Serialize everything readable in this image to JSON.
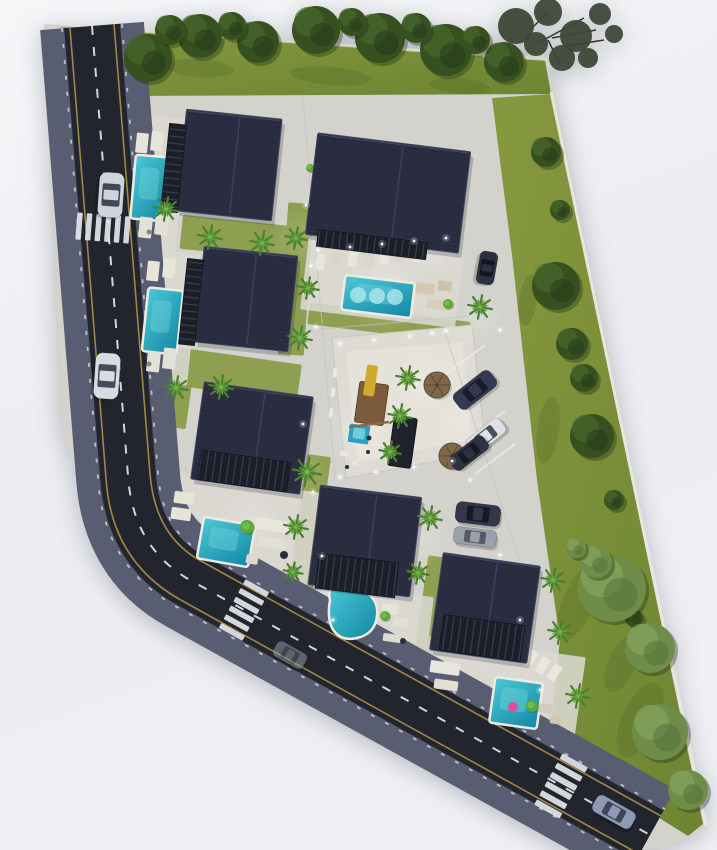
{
  "meta": {
    "label": "villa-resort-site-plan-rendering",
    "width": 717,
    "height": 850
  },
  "palette": {
    "background_top": "#f5f6f8",
    "background_bottom": "#f0f1f4",
    "ground": "#d3d2cc",
    "plaza": "#dedbd4",
    "lawn_light": "#87993f",
    "lawn_dark": "#6d8431",
    "grass_patch": "#8b9c4a",
    "asphalt": "#23252e",
    "curb": "#585d72",
    "road_yellow_line": "#b5974a",
    "road_white": "#e6e8ea",
    "roof_dark": "#2b2e41",
    "slat_dark": "#1c1e28",
    "pool_light": "#47c4d4",
    "pool_dark": "#1287a3",
    "pool_deck": "#eeece2",
    "palm_green": "#4c8030",
    "tree_green": "#36511f",
    "lush_tree_green": "#6f8d49",
    "umbrella_straw": "#7e6848",
    "car_silver": "#d4d7de",
    "car_dark": "#32364a",
    "float_pink": "#d94fa0",
    "playground_wood": "#7b5b39",
    "slide_yellow": "#d2a92f",
    "light_glow": "#ffffff"
  },
  "site": {
    "points": "44,24 548,57 706,828 664,849 614,850 92,520 60,424"
  },
  "lawns": [
    {
      "id": "lawn-top",
      "points": "60,26 545,60 551,94 118,96"
    },
    {
      "id": "lawn-right",
      "points": "492,98 551,94 703,824 688,836 548,748 560,640 537,480 512,255"
    }
  ],
  "lawn_blotches": [
    [
      200,
      68,
      34,
      9,
      4
    ],
    [
      330,
      76,
      40,
      9,
      5
    ],
    [
      460,
      86,
      30,
      8,
      5
    ],
    [
      528,
      300,
      9,
      26,
      8
    ],
    [
      548,
      430,
      11,
      34,
      8
    ],
    [
      580,
      600,
      16,
      44,
      25
    ],
    [
      640,
      720,
      18,
      40,
      25
    ],
    [
      622,
      664,
      14,
      30,
      25
    ]
  ],
  "curb_lines": [
    {
      "d": "M551,92 L706,826",
      "w": 3,
      "c": "#edeae2",
      "o": 0.85
    },
    {
      "d": "M60,26 L546,60",
      "w": 2,
      "c": "#e8e6de",
      "o": 0.6
    }
  ],
  "green_patches": [
    [
      181,
      221,
      120,
      34,
      6
    ],
    [
      148,
      354,
      152,
      38,
      8
    ],
    [
      283,
      203,
      26,
      152,
      4
    ],
    [
      308,
      312,
      162,
      22,
      7
    ],
    [
      298,
      455,
      24,
      132,
      8
    ],
    [
      421,
      556,
      18,
      104,
      8
    ],
    [
      167,
      380,
      22,
      48,
      8
    ]
  ],
  "plaza": {
    "outer": "332,338 472,325 486,452 346,478",
    "inner": "346,352 462,342 472,440 357,462"
  },
  "pads": [
    [
      126,
      116,
      56,
      134,
      6
    ],
    [
      136,
      251,
      58,
      132,
      6
    ],
    [
      304,
      245,
      156,
      74,
      7
    ],
    [
      166,
      482,
      148,
      94,
      8
    ],
    [
      316,
      590,
      114,
      70,
      7
    ],
    [
      422,
      646,
      158,
      94,
      8
    ]
  ],
  "glows": [
    [
      385,
      290,
      42,
      0.3
    ],
    [
      300,
      240,
      30,
      0.2
    ],
    [
      255,
      330,
      30,
      0.2
    ],
    [
      230,
      190,
      28,
      0.18
    ],
    [
      355,
      432,
      38,
      0.26
    ],
    [
      300,
      470,
      28,
      0.2
    ],
    [
      424,
      382,
      30,
      0.24
    ],
    [
      462,
      422,
      26,
      0.2
    ],
    [
      250,
      522,
      30,
      0.2
    ],
    [
      422,
      540,
      28,
      0.2
    ],
    [
      352,
      612,
      28,
      0.2
    ],
    [
      482,
      642,
      30,
      0.22
    ],
    [
      520,
      720,
      26,
      0.2
    ],
    [
      160,
      180,
      24,
      0.15
    ],
    [
      432,
      252,
      26,
      0.18
    ],
    [
      480,
      320,
      24,
      0.2
    ]
  ],
  "road": {
    "center": "M92,26 L128,476 Q133,548 190,580 L650,835",
    "curb_w": 104,
    "asphalt_w": 56,
    "yellow": [
      "M114,24 L150,474 Q155,536 201,561 L661,816",
      "M70,28 L106,478 Q111,560 179,599 L639,854"
    ],
    "ticks": [
      "M122,24 L158,474 Q163,533 205,554 L665,809",
      "M62,28 L98,478 Q103,565 175,606 L635,861"
    ],
    "dash_pattern": "9 12"
  },
  "crosswalks": [
    {
      "id": "crosswalk-north",
      "cx": 103,
      "cy": 228,
      "rot": 4.5,
      "dir": "v",
      "n": 6,
      "step": 9.6,
      "bw": 5.5,
      "bl": 27
    },
    {
      "id": "crosswalk-southwest",
      "cx": 244,
      "cy": 610,
      "rot": 29,
      "dir": "h",
      "n": 6,
      "step": 10,
      "bw": 5.5,
      "bl": 27
    },
    {
      "id": "crosswalk-southeast",
      "cx": 561,
      "cy": 786,
      "rot": 29,
      "dir": "h",
      "n": 6,
      "step": 10.5,
      "bw": 6,
      "bl": 29
    }
  ],
  "parking_lines": [
    [
      445,
      375,
      485,
      345
    ],
    [
      455,
      408,
      495,
      378
    ],
    [
      465,
      441,
      505,
      411
    ],
    [
      475,
      474,
      515,
      444
    ]
  ],
  "drive_lines": [
    [
      303,
      98,
      335,
      478
    ],
    [
      445,
      332,
      520,
      562
    ],
    [
      310,
      330,
      470,
      316
    ]
  ],
  "villas": [
    {
      "id": "villa-1",
      "roof": [
        181,
        114,
        96,
        102,
        6
      ],
      "slats": [
        165,
        124,
        17,
        88,
        6
      ],
      "slatDir": "h"
    },
    {
      "id": "villa-2",
      "roof": [
        199,
        251,
        94,
        96,
        6
      ],
      "slats": [
        183,
        259,
        16,
        86,
        6
      ],
      "slatDir": "h"
    },
    {
      "id": "villa-3",
      "roof": [
        311,
        142,
        154,
        102,
        7
      ],
      "slats": [
        317,
        236,
        110,
        17,
        7
      ],
      "slatDir": "v"
    },
    {
      "id": "villa-4",
      "roof": [
        197,
        389,
        110,
        98,
        8
      ],
      "slats": [
        199,
        456,
        90,
        30,
        8
      ],
      "slatDir": "v"
    },
    {
      "id": "villa-5",
      "roof": [
        314,
        491,
        102,
        100,
        7
      ],
      "slats": [
        317,
        558,
        80,
        35,
        7
      ],
      "slatDir": "v"
    },
    {
      "id": "villa-6",
      "roof": [
        436,
        559,
        98,
        98,
        8
      ],
      "slats": [
        441,
        620,
        82,
        36,
        8
      ],
      "slatDir": "v"
    }
  ],
  "pools": [
    [
      133,
      156,
      35,
      64,
      5
    ],
    [
      145,
      289,
      35,
      64,
      6
    ],
    [
      343,
      279,
      70,
      35,
      7
    ],
    [
      200,
      521,
      52,
      42,
      10
    ],
    [
      492,
      680,
      48,
      46,
      8
    ]
  ],
  "pool_kidney": "M330,600 Q326,586 341,584 Q357,582 366,592 Q379,601 377,616 Q375,634 357,638 Q340,642 332,628 Q327,617 330,600 Z",
  "pool_circles": [
    [
      358,
      295,
      8
    ],
    [
      377,
      296,
      8
    ],
    [
      395,
      297,
      8
    ]
  ],
  "pool_float": [
    513,
    707,
    5
  ],
  "kids_pool": {
    "rect": [
      348,
      424,
      22,
      20,
      8
    ],
    "inner": [
      353,
      428,
      12,
      11,
      8
    ]
  },
  "playground": {
    "platform": [
      357,
      383,
      29,
      41,
      8
    ],
    "slide": [
      365,
      365,
      11,
      31,
      8
    ],
    "beam": [
      349,
      427,
      389,
      422
    ],
    "dots": [
      [
        369,
        438,
        2.5
      ],
      [
        368,
        452,
        2
      ],
      [
        347,
        467,
        2
      ]
    ],
    "bits": [
      [
        340,
        451,
        8,
        5,
        8
      ],
      [
        352,
        461,
        6,
        4,
        8
      ]
    ]
  },
  "pavilion": [
    391,
    417,
    23,
    50,
    8
  ],
  "furniture": [
    [
      136,
      133,
      12,
      20,
      6,
      "#e7e4da"
    ],
    [
      151,
      131,
      12,
      20,
      6,
      "#e7e4da"
    ],
    [
      139,
      217,
      13,
      21,
      6,
      "#e3e0d6"
    ],
    [
      155,
      214,
      13,
      21,
      6,
      "#e3e0d6"
    ],
    [
      147,
      261,
      12,
      20,
      6,
      "#e7e4da"
    ],
    [
      163,
      258,
      12,
      20,
      6,
      "#e7e4da"
    ],
    [
      147,
      351,
      13,
      21,
      6,
      "#e3e0d6"
    ],
    [
      163,
      348,
      13,
      21,
      6,
      "#e3e0d6"
    ],
    [
      316,
      254,
      9,
      16,
      7,
      "#e8e5db"
    ],
    [
      332,
      252,
      9,
      16,
      7,
      "#d9d5c9"
    ],
    [
      348,
      251,
      9,
      16,
      7,
      "#e8e5db"
    ],
    [
      364,
      250,
      9,
      16,
      7,
      "#d9d5c9"
    ],
    [
      380,
      248,
      9,
      16,
      7,
      "#e8e5db"
    ],
    [
      396,
      247,
      9,
      16,
      7,
      "#d9d5c9"
    ],
    [
      412,
      246,
      9,
      16,
      7,
      "#e8e5db"
    ],
    [
      416,
      283,
      18,
      11,
      7,
      "#d4c8b2"
    ],
    [
      438,
      281,
      14,
      10,
      7,
      "#cfc2aa"
    ],
    [
      427,
      300,
      22,
      9,
      7,
      "#d8cdb8"
    ],
    [
      174,
      492,
      20,
      12,
      8,
      "#e6e3d9"
    ],
    [
      171,
      508,
      20,
      12,
      8,
      "#e6e3d9"
    ],
    [
      254,
      519,
      34,
      12,
      10,
      "#e8e5dc"
    ],
    [
      258,
      538,
      28,
      10,
      10,
      "#e2dfd5"
    ],
    [
      246,
      555,
      12,
      9,
      10,
      "#dcd8cd"
    ],
    [
      382,
      604,
      16,
      10,
      8,
      "#e6e3d9"
    ],
    [
      394,
      618,
      14,
      9,
      8,
      "#e2dfd5"
    ],
    [
      383,
      634,
      18,
      8,
      8,
      "#dedbd1"
    ],
    [
      430,
      662,
      30,
      12,
      8,
      "#e8e5dc"
    ],
    [
      434,
      680,
      24,
      10,
      8,
      "#e2dfd5"
    ],
    [
      526,
      650,
      9,
      17,
      32,
      "#eae7dd"
    ],
    [
      538,
      657,
      9,
      17,
      32,
      "#eae7dd"
    ],
    [
      550,
      664,
      9,
      17,
      32,
      "#eae7dd"
    ],
    [
      538,
      704,
      14,
      9,
      8,
      "#d6cbbb"
    ],
    [
      550,
      716,
      12,
      8,
      8,
      "#d2c6b5"
    ],
    [
      333,
      368,
      4,
      9,
      8,
      "#eceadf"
    ],
    [
      331,
      388,
      4,
      9,
      8,
      "#eceadf"
    ],
    [
      329,
      408,
      4,
      9,
      8,
      "#eceadf"
    ]
  ],
  "tables": [
    [
      284,
      555,
      4,
      "#2b2e3a"
    ],
    [
      403,
      641,
      3,
      "#2b2e3a"
    ],
    [
      149,
      232,
      2.5,
      "#8a857c"
    ],
    [
      149,
      364,
      2.5,
      "#8a857c"
    ]
  ],
  "bushes": [
    [
      247,
      527,
      7
    ],
    [
      532,
      706,
      6
    ],
    [
      385,
      616,
      5
    ],
    [
      448,
      304,
      5
    ],
    [
      310,
      168,
      4
    ]
  ],
  "umbrellas": [
    [
      437,
      385,
      13
    ],
    [
      452,
      456,
      13
    ]
  ],
  "cars": [
    {
      "id": "car-sedan-north",
      "c": [
        111,
        195
      ],
      "l": 45,
      "w": 25,
      "rot": 94,
      "body": "#cfd3db",
      "glass": "#424759",
      "o": 1
    },
    {
      "id": "car-sedan-west",
      "c": [
        107,
        376
      ],
      "l": 46,
      "w": 25,
      "rot": 94,
      "body": "#d8dbe1",
      "glass": "#454a5c",
      "o": 1
    },
    {
      "id": "car-ghost-south",
      "c": [
        290,
        655
      ],
      "l": 34,
      "w": 17,
      "rot": 29,
      "body": "#9aa0ac",
      "glass": "#5d6270",
      "o": 0.5
    },
    {
      "id": "car-sedan-southeast",
      "c": [
        614,
        812
      ],
      "l": 44,
      "w": 19,
      "rot": 29,
      "body": "#8e99b4",
      "glass": "#3e4559",
      "o": 1
    },
    {
      "id": "car-drive-east",
      "c": [
        487,
        268
      ],
      "l": 33,
      "w": 18,
      "rot": 100,
      "body": "#2c3040",
      "glass": "#14161f",
      "o": 1
    },
    {
      "id": "car-parked-suv",
      "c": [
        475,
        390
      ],
      "l": 46,
      "w": 20,
      "rot": -38,
      "body": "#343850",
      "glass": "#181b28",
      "o": 1
    },
    {
      "id": "car-parked-white",
      "c": [
        486,
        436
      ],
      "l": 42,
      "w": 18,
      "rot": -38,
      "body": "#dfe1e6",
      "glass": "#4a4f60",
      "o": 1
    },
    {
      "id": "car-parked-dark",
      "c": [
        469,
        453
      ],
      "l": 42,
      "w": 17,
      "rot": -38,
      "body": "#2d3142",
      "glass": "#161926",
      "o": 1
    },
    {
      "id": "car-villa6-suv",
      "c": [
        478,
        514
      ],
      "l": 45,
      "w": 21,
      "rot": 7,
      "body": "#333749",
      "glass": "#161923",
      "o": 1
    },
    {
      "id": "car-villa6-gray",
      "c": [
        475,
        537
      ],
      "l": 43,
      "w": 17,
      "rot": 7,
      "body": "#9ba1ab",
      "glass": "#555a68",
      "o": 1
    }
  ],
  "palms": [
    [
      166,
      209,
      1
    ],
    [
      210,
      237,
      1
    ],
    [
      262,
      243,
      1
    ],
    [
      296,
      238,
      0.9
    ],
    [
      176,
      388,
      1
    ],
    [
      221,
      387,
      1
    ],
    [
      300,
      338,
      1
    ],
    [
      308,
      288,
      0.9
    ],
    [
      307,
      472,
      1.2
    ],
    [
      296,
      527,
      1
    ],
    [
      408,
      378,
      1
    ],
    [
      400,
      416,
      1
    ],
    [
      390,
      452,
      0.9
    ],
    [
      480,
      307,
      1
    ],
    [
      430,
      518,
      1
    ],
    [
      418,
      573,
      0.9
    ],
    [
      553,
      580,
      1
    ],
    [
      560,
      632,
      1
    ],
    [
      578,
      696,
      1
    ],
    [
      293,
      572,
      0.8
    ]
  ],
  "trees_dark": [
    [
      148,
      58,
      24
    ],
    [
      200,
      36,
      22
    ],
    [
      258,
      42,
      21
    ],
    [
      316,
      30,
      24
    ],
    [
      380,
      38,
      25
    ],
    [
      446,
      50,
      26
    ],
    [
      504,
      62,
      20
    ],
    [
      170,
      30,
      15
    ],
    [
      232,
      26,
      14
    ],
    [
      352,
      22,
      14
    ],
    [
      416,
      28,
      15
    ],
    [
      476,
      40,
      14
    ],
    [
      546,
      152,
      15
    ],
    [
      560,
      210,
      10
    ],
    [
      556,
      286,
      24
    ],
    [
      572,
      344,
      16
    ],
    [
      584,
      378,
      14
    ],
    [
      592,
      436,
      22
    ],
    [
      614,
      500,
      10
    ],
    [
      634,
      618,
      9
    ]
  ],
  "trees_lush": [
    [
      612,
      588,
      34
    ],
    [
      650,
      648,
      25
    ],
    [
      660,
      732,
      28
    ],
    [
      688,
      790,
      20
    ],
    [
      596,
      562,
      16
    ],
    [
      576,
      548,
      10
    ]
  ],
  "tree_overhang": {
    "circles": [
      [
        516,
        26,
        18
      ],
      [
        548,
        12,
        14
      ],
      [
        576,
        36,
        16
      ],
      [
        600,
        14,
        11
      ],
      [
        562,
        58,
        13
      ],
      [
        536,
        44,
        12
      ],
      [
        588,
        58,
        10
      ],
      [
        614,
        34,
        9
      ]
    ],
    "branches": [
      [
        540,
        42,
        584,
        18
      ],
      [
        552,
        38,
        596,
        30
      ],
      [
        548,
        40,
        560,
        64
      ],
      [
        530,
        30,
        548,
        12
      ],
      [
        566,
        46,
        604,
        40
      ]
    ]
  },
  "light_dots": [
    [
      318,
      250
    ],
    [
      350,
      247
    ],
    [
      382,
      244
    ],
    [
      414,
      241
    ],
    [
      446,
      238
    ],
    [
      340,
      344
    ],
    [
      374,
      340
    ],
    [
      410,
      336
    ],
    [
      446,
      331
    ],
    [
      340,
      477
    ],
    [
      376,
      472
    ],
    [
      414,
      467
    ],
    [
      452,
      461
    ],
    [
      306,
      205
    ],
    [
      311,
      266
    ],
    [
      316,
      327
    ],
    [
      303,
      424
    ],
    [
      313,
      492
    ],
    [
      322,
      556
    ],
    [
      333,
      620
    ],
    [
      432,
      333
    ],
    [
      500,
      330
    ],
    [
      470,
      480
    ],
    [
      500,
      555
    ],
    [
      520,
      620
    ],
    [
      540,
      690
    ]
  ]
}
